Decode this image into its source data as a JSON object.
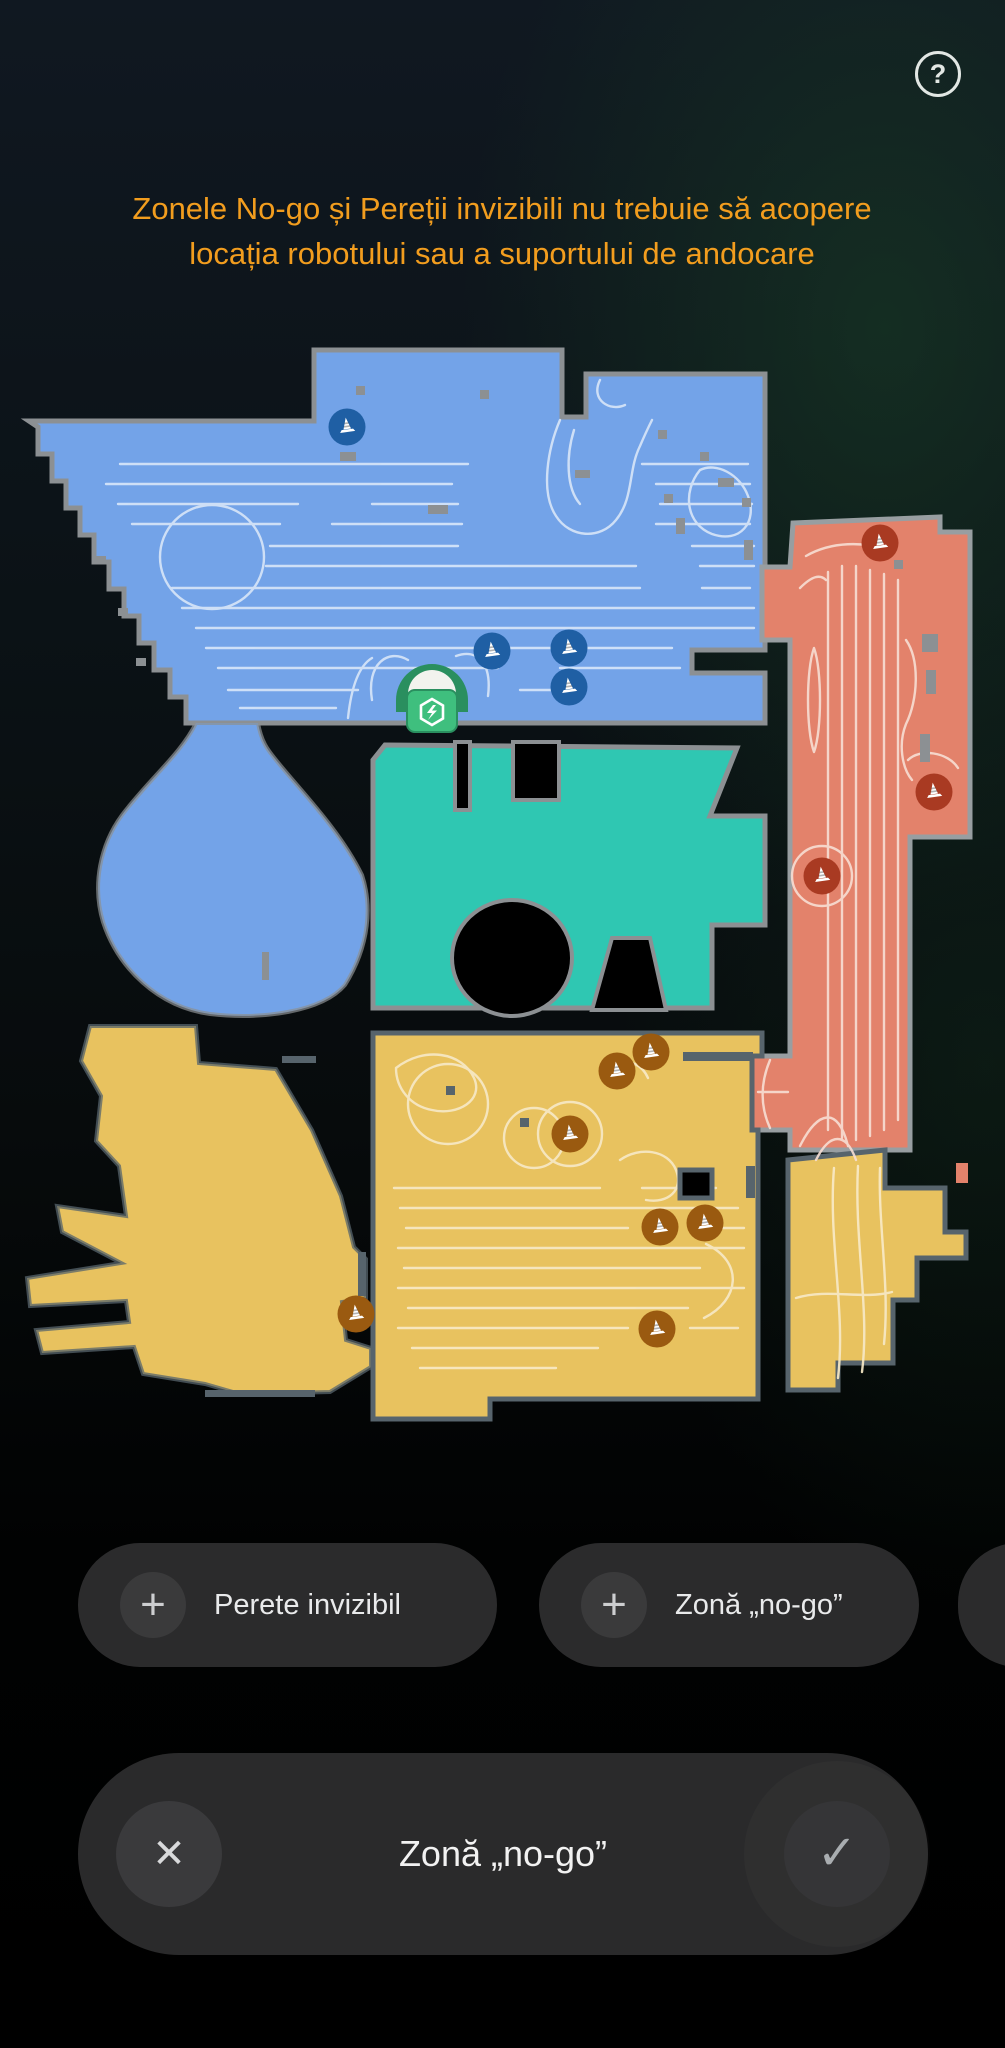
{
  "header": {
    "help_label": "?",
    "warning_text": "Zonele No-go și Pereții invizibili  nu trebuie să acopere locația robotului sau a suportului de andocare",
    "warning_color": "#f29d1e"
  },
  "toolbar": {
    "buttons": [
      {
        "id": "invisible-wall",
        "icon": "plus",
        "plus_glyph": "+",
        "label": "Perete invizibil"
      },
      {
        "id": "no-go-zone",
        "icon": "plus",
        "plus_glyph": "+",
        "label": "Zonă „no-go”"
      }
    ],
    "partial_button_visible": true
  },
  "action_bar": {
    "title": "Zonă „no-go”",
    "cancel_glyph": "✕",
    "confirm_glyph": "✓"
  },
  "map": {
    "room_colors": {
      "blue": "#73a3e8",
      "teal": "#2fc7b2",
      "salmon": "#e3826b",
      "yellow": "#e8c25f"
    },
    "wall_colors": {
      "light": "#8c9093",
      "dark": "#57646c"
    },
    "dock": {
      "x": 432,
      "y": 700,
      "arch_color": "#2a8f5f",
      "pad_color": "#3fbf7e",
      "robot_color": "#f2f3ee"
    },
    "cones": [
      {
        "x": 347,
        "y": 427,
        "color": "#1f5fa4"
      },
      {
        "x": 492,
        "y": 651,
        "color": "#1f5fa4"
      },
      {
        "x": 569,
        "y": 648,
        "color": "#1f5fa4"
      },
      {
        "x": 569,
        "y": 687,
        "color": "#1f5fa4"
      },
      {
        "x": 880,
        "y": 543,
        "color": "#a93a22"
      },
      {
        "x": 934,
        "y": 792,
        "color": "#a93a22"
      },
      {
        "x": 822,
        "y": 876,
        "color": "#a93a22"
      },
      {
        "x": 651,
        "y": 1052,
        "color": "#9a5a10"
      },
      {
        "x": 617,
        "y": 1071,
        "color": "#9a5a10"
      },
      {
        "x": 570,
        "y": 1134,
        "color": "#9a5a10"
      },
      {
        "x": 660,
        "y": 1227,
        "color": "#9a5a10"
      },
      {
        "x": 705,
        "y": 1223,
        "color": "#9a5a10"
      },
      {
        "x": 657,
        "y": 1329,
        "color": "#9a5a10"
      },
      {
        "x": 356,
        "y": 1314,
        "color": "#9a5a10"
      }
    ]
  }
}
